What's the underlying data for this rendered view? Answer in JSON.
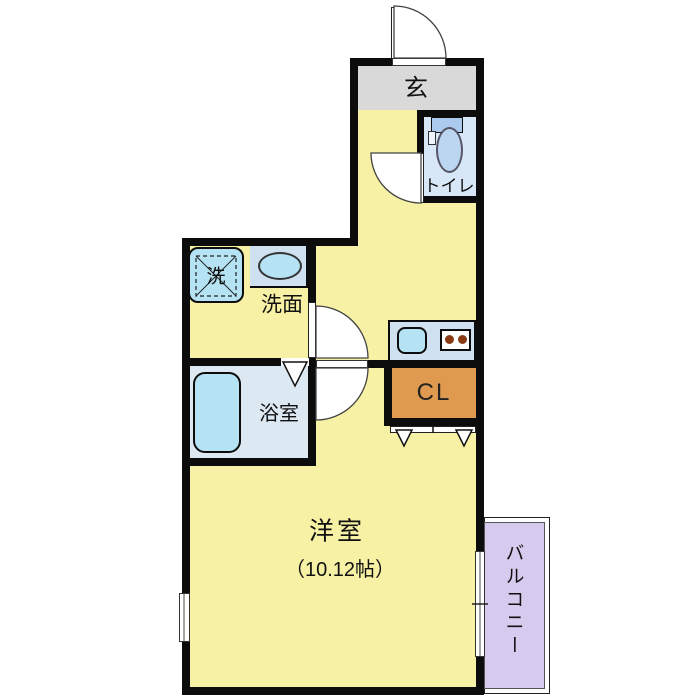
{
  "title": "apartment-floor-plan",
  "rooms": {
    "genkan": {
      "label": "玄"
    },
    "toilet": {
      "label": "トイレ"
    },
    "washroom": {
      "label": "洗面"
    },
    "washing_machine": {
      "label": "洗"
    },
    "bathroom": {
      "label": "浴室"
    },
    "closet": {
      "label": "CL"
    },
    "main_room": {
      "label": "洋室",
      "size": "（10.12帖）"
    },
    "balcony": {
      "label": "バルコニー"
    }
  },
  "colors": {
    "wall": "#0c0c0c",
    "room-yellow": "#f6f1a4",
    "genkan-gray": "#d9d9d9",
    "toilet-blue": "#d7e7f7",
    "bathroom-blue": "#dde9f2",
    "counter-blue": "#cfe0f1",
    "fixture-cyan": "#b5e3f3",
    "tank-blue": "#abcaee",
    "bowl-blue": "#bcd6f1",
    "closet-orange": "#df9a50",
    "balcony-purple": "#d6caee",
    "burner-brown": "#8a3a12"
  }
}
